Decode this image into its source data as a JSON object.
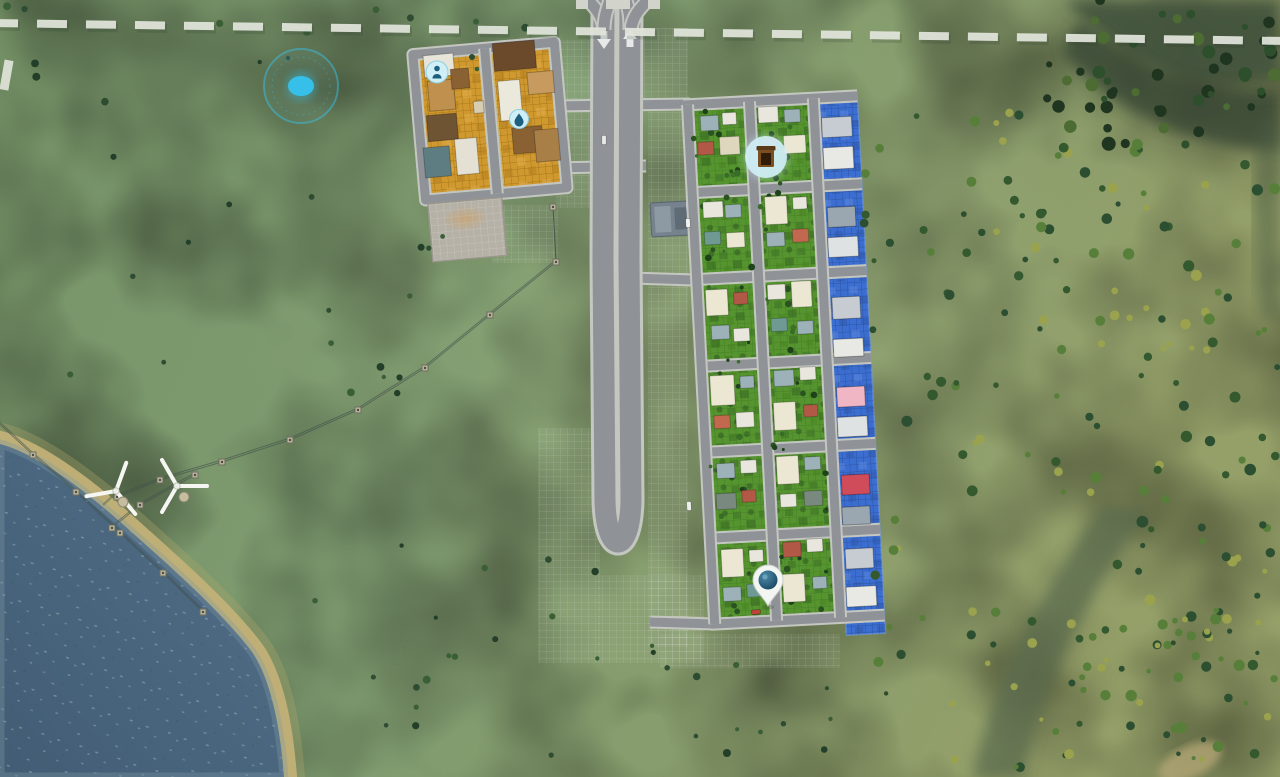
{
  "scene": {
    "width": 1280,
    "height": 777
  },
  "colors": {
    "grass_base": "#7e9b70",
    "grass_light": "#8aa377",
    "grass_olive": "#95a069",
    "forest_dark": "#42533c",
    "forest_core": "#374734",
    "water_deep": "#455f76",
    "water_shallow": "#52708a",
    "beach": "#c2b178",
    "beach_soft": "#ada569",
    "road_surface": "#8f9398",
    "road_casing": "#c4c6c0",
    "zone_ind": "#d0992f",
    "zone_ind_line": "#a8781a",
    "zone_res": "#55942e",
    "zone_res_line": "#468128",
    "zone_com": "#3b6ed0",
    "zone_com_line": "#2d56a6",
    "boundary": "#e2e5dc",
    "power_line": "#41504a",
    "pylon": "#bcb49a",
    "turbine": "#f5f6f2",
    "icon_bubble": "#cfeef5",
    "icon_glyph": "#1c5f80",
    "trash_brown": "#7a4e1e",
    "trash_dark": "#2e1c08",
    "trash_lid": "#5a3a16",
    "pin_white": "#f3f5f3",
    "pin_globe_light": "#3a7a9c",
    "pin_globe_dark": "#123c55",
    "pulse": "#35c3ee",
    "pad": "#b5b1a7",
    "service_building": "#76838e",
    "arrow": "#eef0ee"
  },
  "terrain": {
    "water_path": "M 0 444 C 30 452 70 478 118 520 C 170 566 222 612 252 652 C 270 678 280 724 284 777 L 0 777 Z",
    "forest_blobs": [
      {
        "d": "M 1062 0 L 1280 0 L 1280 78 C 1200 96 1150 70 1118 44 C 1094 28 1076 12 1062 0 Z",
        "fill": "#42533c",
        "op": 0.9
      },
      {
        "d": "M 1080 20 C 1140 70 1210 96 1280 90 L 1280 150 C 1190 150 1110 108 1062 52 Z",
        "fill": "#374734",
        "op": 0.8
      },
      {
        "d": "M 1262 120 C 1250 180 1252 250 1262 320 L 1280 320 L 1280 120 Z",
        "fill": "#4c5c42",
        "op": 0.5
      },
      {
        "d": "M 1148 512 C 1086 596 1046 676 1022 777 L 972 777 C 998 672 1042 588 1104 506 Z",
        "fill": "#5a6a4e",
        "op": 0.75
      }
    ],
    "sand_spot": {
      "cx": 1190,
      "cy": 762,
      "rx": 34,
      "ry": 16,
      "rot": -25,
      "fill": "#b3a674"
    }
  },
  "boundary": {
    "path": "M -12 23 L 1292 41",
    "dash": "30 19",
    "width": 8,
    "side_dash": {
      "x": 2,
      "y": 60,
      "w": 9,
      "h": 30,
      "rot": 10
    }
  },
  "pale_grids": [
    {
      "x": 556,
      "y": 40,
      "w": 40,
      "h": 168
    },
    {
      "x": 644,
      "y": 28,
      "w": 44,
      "h": 74
    },
    {
      "x": 648,
      "y": 102,
      "w": 40,
      "h": 545
    },
    {
      "x": 538,
      "y": 428,
      "w": 62,
      "h": 235
    },
    {
      "x": 598,
      "y": 575,
      "w": 106,
      "h": 88
    },
    {
      "x": 660,
      "y": 634,
      "w": 180,
      "h": 34
    },
    {
      "x": 492,
      "y": 205,
      "w": 66,
      "h": 58
    }
  ],
  "roads": {
    "main_loop": "M 604 -2 L 603 260 L 605 500 C 606 556 630 556 631 500 L 629 260 L 630 -2",
    "ramps": [
      "M 582 -6 C 596 8 603 16 604 30",
      "M 612 -6 C 606 12 604 18 604 30",
      "M 624 -6 C 630 12 630 18 630 30",
      "M 654 -6 C 640 8 632 16 631 30"
    ],
    "caps": [
      [
        576,
        0
      ],
      [
        606,
        0
      ],
      [
        618,
        0
      ],
      [
        648,
        0
      ]
    ],
    "connectors": [
      "M 554 106 L 690 104",
      "M 554 168 L 646 166",
      "M 600 277 L 694 280",
      "M 650 622 L 714 624"
    ],
    "arrow_down": "M600.5 31 h7 v8 h3.5 l-7 10 -7 -10 h3.5 z",
    "arrow_up": "M626.5 47 h7 v-8 h3.5 l-7 -10 -7 10 h3.5 z"
  },
  "power": {
    "chains": [
      [
        [
          553,
          207
        ],
        [
          556,
          262
        ],
        [
          490,
          315
        ],
        [
          425,
          368
        ],
        [
          358,
          410
        ],
        [
          290,
          440
        ],
        [
          222,
          462
        ],
        [
          160,
          480
        ],
        [
          117,
          497
        ]
      ],
      [
        [
          -10,
          415
        ],
        [
          33,
          455
        ],
        [
          76,
          492
        ],
        [
          120,
          533
        ],
        [
          163,
          573
        ],
        [
          203,
          612
        ]
      ],
      [
        [
          195,
          475
        ],
        [
          140,
          505
        ],
        [
          112,
          528
        ]
      ]
    ]
  },
  "turbines": [
    {
      "x": 116,
      "y": 491,
      "rot": 20
    },
    {
      "x": 177,
      "y": 486,
      "rot": -30
    }
  ],
  "vehicles": [
    {
      "x": 688,
      "y": 223,
      "r": -3,
      "c": "#f2f3f0"
    },
    {
      "x": 689,
      "y": 506,
      "r": -3,
      "c": "#eef0ee"
    },
    {
      "x": 756,
      "y": 612,
      "r": 85,
      "c": "#c14338"
    },
    {
      "x": 604,
      "y": 140,
      "r": 0,
      "c": "#e8e9e6"
    }
  ],
  "service_building": {
    "transform": "translate(650,203) rotate(-3)"
  },
  "districts": {
    "industrial": {
      "transform": "translate(408,45) rotate(-5)",
      "border_road": "M 4 10 H 146 V 156 H 4 Z",
      "mid_road": "M 76 10 V 156",
      "zones": [
        {
          "x": 9,
          "y": 15,
          "w": 61,
          "h": 136
        },
        {
          "x": 83,
          "y": 15,
          "w": 58,
          "h": 136
        }
      ],
      "pad": {
        "x": 6,
        "y": 160,
        "w": 74,
        "h": 58
      },
      "buildings": [
        [
          14,
          12,
          30,
          22,
          "#e7e4da"
        ],
        [
          16,
          38,
          26,
          30,
          "#c0904f"
        ],
        [
          12,
          72,
          30,
          26,
          "#6f5434"
        ],
        [
          6,
          104,
          26,
          30,
          "#5e7d82"
        ],
        [
          38,
          98,
          22,
          36,
          "#e4e1d4"
        ],
        [
          40,
          28,
          18,
          20,
          "#8a6132"
        ],
        [
          60,
          62,
          10,
          12,
          "#d8cdb0"
        ],
        [
          84,
          6,
          42,
          28,
          "#6b4a2c"
        ],
        [
          116,
          38,
          26,
          22,
          "#c79b5f"
        ],
        [
          86,
          44,
          22,
          40,
          "#ebe8dc"
        ],
        [
          96,
          92,
          30,
          26,
          "#8a6132"
        ],
        [
          118,
          96,
          24,
          32,
          "#a97f48"
        ]
      ]
    },
    "residential": {
      "transform": "translate(683,95) rotate(-3)",
      "rows": [
        10,
        98,
        185,
        272,
        358,
        444,
        530
      ],
      "cols": [
        4,
        66,
        130
      ],
      "x_extent": [
        0,
        174
      ],
      "zones": [
        {
          "x": 8,
          "y": 14,
          "w": 54,
          "h": 512
        },
        {
          "x": 70,
          "y": 14,
          "w": 56,
          "h": 512
        }
      ],
      "house_palette": {
        "cream": "#ece7d3",
        "cream2": "#ded6bd",
        "white": "#e9e7dd",
        "grey": "#9db1b9",
        "red": "#b25847",
        "red2": "#c2684e",
        "teal": "#6f9a94",
        "dark": "#7a897f"
      },
      "houses": [
        [
          16,
          22,
          18,
          15,
          "grey"
        ],
        [
          38,
          20,
          14,
          12,
          "white"
        ],
        [
          12,
          48,
          16,
          13,
          "red"
        ],
        [
          34,
          44,
          20,
          18,
          "cream2"
        ],
        [
          14,
          108,
          20,
          16,
          "white"
        ],
        [
          36,
          112,
          16,
          13,
          "grey"
        ],
        [
          14,
          138,
          16,
          13,
          "teal"
        ],
        [
          36,
          140,
          18,
          15,
          "cream"
        ],
        [
          12,
          196,
          22,
          26,
          "cream"
        ],
        [
          40,
          200,
          14,
          12,
          "red"
        ],
        [
          16,
          232,
          18,
          14,
          "grey"
        ],
        [
          38,
          236,
          16,
          13,
          "white"
        ],
        [
          12,
          282,
          24,
          30,
          "cream"
        ],
        [
          42,
          284,
          14,
          12,
          "grey"
        ],
        [
          14,
          322,
          16,
          13,
          "red2"
        ],
        [
          36,
          320,
          18,
          15,
          "white"
        ],
        [
          14,
          370,
          18,
          15,
          "grey"
        ],
        [
          38,
          368,
          16,
          13,
          "white"
        ],
        [
          12,
          400,
          20,
          16,
          "dark"
        ],
        [
          38,
          398,
          14,
          12,
          "red"
        ],
        [
          14,
          456,
          22,
          28,
          "cream"
        ],
        [
          42,
          458,
          14,
          12,
          "white"
        ],
        [
          14,
          494,
          18,
          14,
          "grey"
        ],
        [
          38,
          492,
          16,
          13,
          "teal"
        ],
        [
          74,
          16,
          20,
          16,
          "white"
        ],
        [
          100,
          20,
          16,
          13,
          "grey"
        ],
        [
          76,
          48,
          16,
          13,
          "red"
        ],
        [
          98,
          46,
          22,
          18,
          "cream"
        ],
        [
          76,
          106,
          22,
          28,
          "cream"
        ],
        [
          104,
          108,
          14,
          12,
          "white"
        ],
        [
          76,
          142,
          18,
          14,
          "grey"
        ],
        [
          102,
          140,
          16,
          13,
          "red2"
        ],
        [
          74,
          194,
          18,
          15,
          "white"
        ],
        [
          98,
          192,
          20,
          26,
          "cream"
        ],
        [
          76,
          228,
          16,
          13,
          "teal"
        ],
        [
          102,
          232,
          16,
          13,
          "grey"
        ],
        [
          76,
          280,
          20,
          16,
          "grey"
        ],
        [
          102,
          278,
          16,
          13,
          "white"
        ],
        [
          74,
          312,
          22,
          28,
          "cream"
        ],
        [
          104,
          316,
          14,
          12,
          "red"
        ],
        [
          74,
          366,
          22,
          28,
          "cream"
        ],
        [
          102,
          368,
          16,
          13,
          "grey"
        ],
        [
          76,
          404,
          16,
          13,
          "white"
        ],
        [
          100,
          402,
          18,
          15,
          "dark"
        ],
        [
          76,
          452,
          18,
          15,
          "red"
        ],
        [
          100,
          450,
          16,
          13,
          "white"
        ],
        [
          74,
          484,
          22,
          28,
          "cream"
        ],
        [
          104,
          488,
          14,
          12,
          "grey"
        ]
      ]
    },
    "commercial": {
      "zone": {
        "x": 135,
        "y": 12,
        "w": 39,
        "h": 536
      },
      "buildings": [
        [
          137,
          30,
          30,
          20,
          "#c6ccd2"
        ],
        [
          137,
          60,
          30,
          22,
          "#e8e8e4"
        ],
        [
          138,
          120,
          28,
          20,
          "#9aa6b0"
        ],
        [
          137,
          150,
          30,
          20,
          "#dfe2e2"
        ],
        [
          138,
          210,
          28,
          22,
          "#c6ccd2"
        ],
        [
          137,
          252,
          30,
          18,
          "#e8e8e4"
        ],
        [
          138,
          300,
          28,
          20,
          "#f0b6c4"
        ],
        [
          137,
          330,
          30,
          20,
          "#dfe2e2"
        ],
        [
          138,
          388,
          28,
          20,
          "#d04c5a"
        ],
        [
          137,
          420,
          28,
          18,
          "#9aa6b0"
        ],
        [
          138,
          462,
          28,
          20,
          "#c6ccd2"
        ],
        [
          137,
          500,
          30,
          20,
          "#e8e8e4"
        ]
      ]
    }
  },
  "icons": {
    "pulse_effect": {
      "x": 301,
      "y": 86
    },
    "worker_alert": {
      "x": 437,
      "y": 72,
      "glyph": "citizen"
    },
    "water_alert": {
      "x": 519,
      "y": 119,
      "glyph": "droplet"
    },
    "garbage_alert": {
      "x": 766,
      "y": 157,
      "glyph": "trash-can"
    },
    "map_pin": {
      "x": 768,
      "y": 584,
      "glyph": "globe-pin"
    }
  },
  "tree_fields": [
    {
      "x": 30,
      "y": 55,
      "w": 540,
      "h": 350,
      "count": 24,
      "rmin": 2,
      "rmax": 4,
      "palette": [
        "#2d4c31",
        "#3a5f37",
        "#243f29"
      ],
      "seed": 7
    },
    {
      "x": 240,
      "y": 540,
      "w": 420,
      "h": 220,
      "count": 18,
      "rmin": 2,
      "rmax": 4,
      "palette": [
        "#2d4c31",
        "#3a5f37",
        "#243f29"
      ],
      "seed": 11
    },
    {
      "x": 640,
      "y": 645,
      "w": 330,
      "h": 120,
      "count": 14,
      "rmin": 2,
      "rmax": 4,
      "palette": [
        "#2d4c31",
        "#3a5f37",
        "#243f29"
      ],
      "seed": 13
    },
    {
      "x": 862,
      "y": 110,
      "w": 190,
      "h": 560,
      "count": 60,
      "rmin": 2.5,
      "rmax": 5.5,
      "palette": [
        "#2d4f31",
        "#577f3a",
        "#9aa24e",
        "#35592f"
      ],
      "seed": 23
    },
    {
      "x": 1055,
      "y": 140,
      "w": 225,
      "h": 630,
      "count": 120,
      "rmin": 2.5,
      "rmax": 6,
      "palette": [
        "#2d4f31",
        "#577f3a",
        "#9aa24e",
        "#35592f"
      ],
      "seed": 31
    },
    {
      "x": 1045,
      "y": 0,
      "w": 235,
      "h": 150,
      "count": 50,
      "rmin": 3,
      "rmax": 7,
      "palette": [
        "#20351f",
        "#2d4f2c",
        "#4c6c33"
      ],
      "seed": 41
    },
    {
      "x": 0,
      "y": 0,
      "w": 560,
      "h": 45,
      "count": 8,
      "rmin": 2,
      "rmax": 4,
      "palette": [
        "#2d4c31",
        "#3a5f37"
      ],
      "seed": 61
    },
    {
      "x": 950,
      "y": 610,
      "w": 330,
      "h": 160,
      "count": 36,
      "rmin": 2,
      "rmax": 5,
      "palette": [
        "#2d4f31",
        "#577f3a",
        "#9aa24e"
      ],
      "seed": 67
    },
    {
      "x": 8,
      "y": 14,
      "w": 52,
      "h": 510,
      "count": 46,
      "rmin": 1.5,
      "rmax": 3.5,
      "palette": [
        "#2b5322",
        "#386d27",
        "#1e421a"
      ],
      "seed": 51,
      "layer": "res-trees"
    },
    {
      "x": 70,
      "y": 14,
      "w": 54,
      "h": 510,
      "count": 48,
      "rmin": 1.5,
      "rmax": 3.5,
      "palette": [
        "#2b5322",
        "#386d27",
        "#1e421a"
      ],
      "seed": 57,
      "layer": "res-trees"
    }
  ]
}
